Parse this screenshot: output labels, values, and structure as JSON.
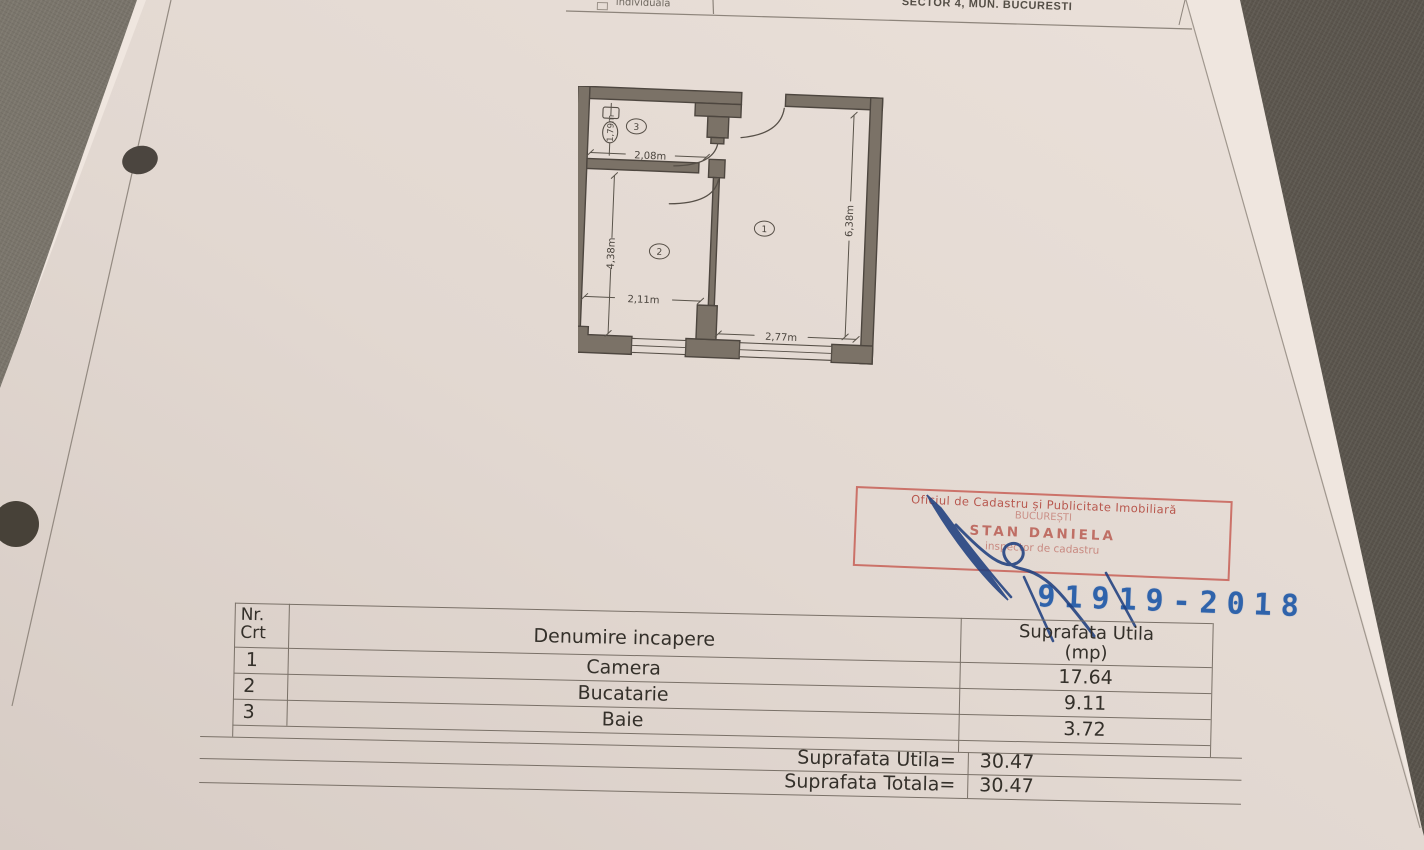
{
  "top_strip": {
    "left_label": "individuala",
    "right_label": "SECTOR 4, MUN. BUCURESTI"
  },
  "plan": {
    "room_labels": {
      "room1": "1",
      "room2": "2",
      "room3": "3"
    },
    "dims": {
      "bath_width": "2,08m",
      "bath_height": "1,79m",
      "kitchen_height": "4,38m",
      "kitchen_width": "2,11m",
      "camera_width": "2,77m",
      "camera_height": "6,38m"
    }
  },
  "stamp": {
    "line1": "Oficiul de Cadastru și Publicitate Imobiliară",
    "line2": "BUCUREȘTI",
    "line3": "STAN DANIELA",
    "line4": "inspector de cadastru",
    "color": "#b2463c"
  },
  "registration_number": "91919-2018",
  "registration_color": "#2f63ab",
  "table": {
    "headers": {
      "col1_line1": "Nr.",
      "col1_line2": "Crt",
      "col2": "Denumire incapere",
      "col3_line1": "Suprafata Utila",
      "col3_line2": "(mp)"
    },
    "rows": [
      {
        "nr": "1",
        "name": "Camera",
        "area": "17.64"
      },
      {
        "nr": "2",
        "name": "Bucatarie",
        "area": "9.11"
      },
      {
        "nr": "3",
        "name": "Baie",
        "area": "3.72"
      }
    ],
    "totals": [
      {
        "label": "Suprafata Utila=",
        "value": "30.47"
      },
      {
        "label": "Suprafata Totala=",
        "value": "30.47"
      }
    ]
  }
}
